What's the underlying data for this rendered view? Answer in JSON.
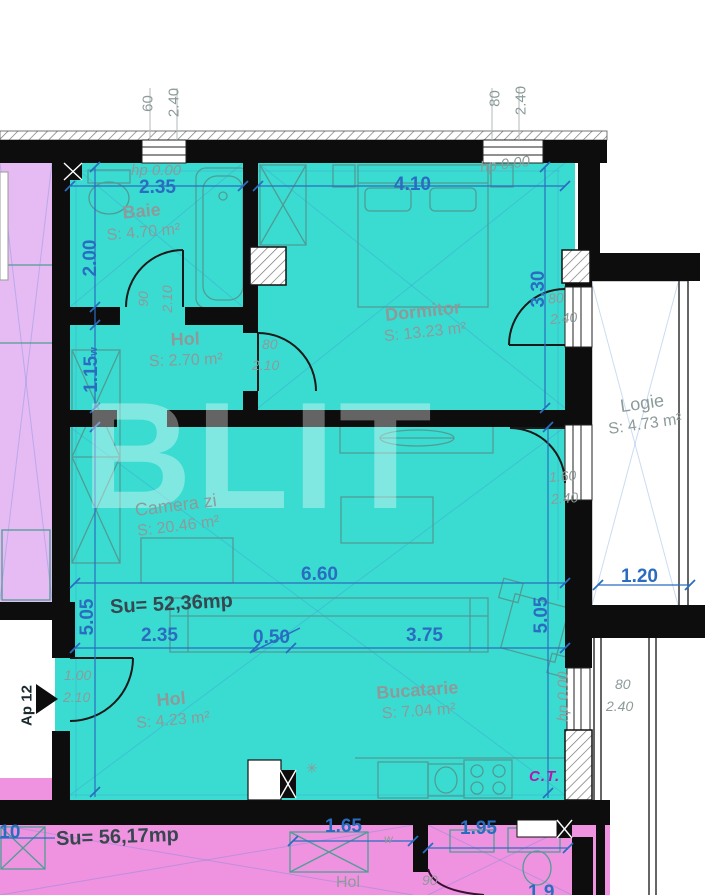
{
  "title": "Apartment floor plan Ap 12",
  "colors": {
    "cyan": "#3adcd1",
    "pink": "#ef93e0",
    "violet": "#e6baf3",
    "blue": "#2a6dc0",
    "gray": "#8d9a9a",
    "dark": "#37474f",
    "magenta": "#b515ae",
    "wall": "#0d0d0d"
  },
  "watermark": "BLIT",
  "apartment": {
    "number_label": "Ap 12",
    "total_area": "Su= 52,36mp",
    "lower_apartment_area": "Su= 56,17mp",
    "boiler_label": "C.T."
  },
  "rooms": [
    {
      "name": "Baie",
      "area": "S: 4.70 m²"
    },
    {
      "name": "Dormitor",
      "area": "S: 13.23 m²"
    },
    {
      "name": "Hol",
      "area": "S: 2.70 m²"
    },
    {
      "name": "Camera zi",
      "area": "S: 20.46 m²"
    },
    {
      "name": "Logie",
      "area": "S: 4.73 m²"
    },
    {
      "name": "Hol",
      "area": "S: 4.23 m²"
    },
    {
      "name": "Bucatarie",
      "area": "S: 7.04 m²"
    },
    {
      "name": "Hol",
      "area": ""
    }
  ],
  "levels": {
    "hp_top_left": "hp 0.00",
    "hp_top_right": "hp 0.00",
    "hp_kitchen": "hp 0.00"
  },
  "dims": {
    "win_tl_w": "60",
    "win_tl_h": "2.40",
    "win_tr_w": "80",
    "win_tr_h": "2.40",
    "baie_w": "2.35",
    "dorm_w": "4.10",
    "baie_h": "2.00",
    "hol_h": "1.15",
    "hol_h_sub": "w",
    "door_baie_w": "90",
    "door_baie_h": "2.10",
    "door_dorm_w": "80",
    "door_dorm_h": "2.10",
    "dorm_r_h": "3.30",
    "door_logie1_w": "80",
    "door_logie1_h": "2.40",
    "door_logie2_w": "1.60",
    "door_logie2_h": "2.40",
    "total_w": "6.60",
    "logie_w": "1.20",
    "left_h": "5.05",
    "right_h": "5.05",
    "bot_1": "2.35",
    "bot_2": "0.50",
    "bot_3": "3.75",
    "entry_w": "1.00",
    "entry_h": "2.10",
    "win_kitchen_w": "80",
    "win_kitchen_h": "2.40",
    "pink_left_partial": ".10",
    "pink_1": "1.65",
    "pink_1_sub": "w",
    "pink_2": "1.95",
    "pink_door": "90",
    "pink_right_partial": "1.9",
    "vent_symbol": "✳"
  }
}
